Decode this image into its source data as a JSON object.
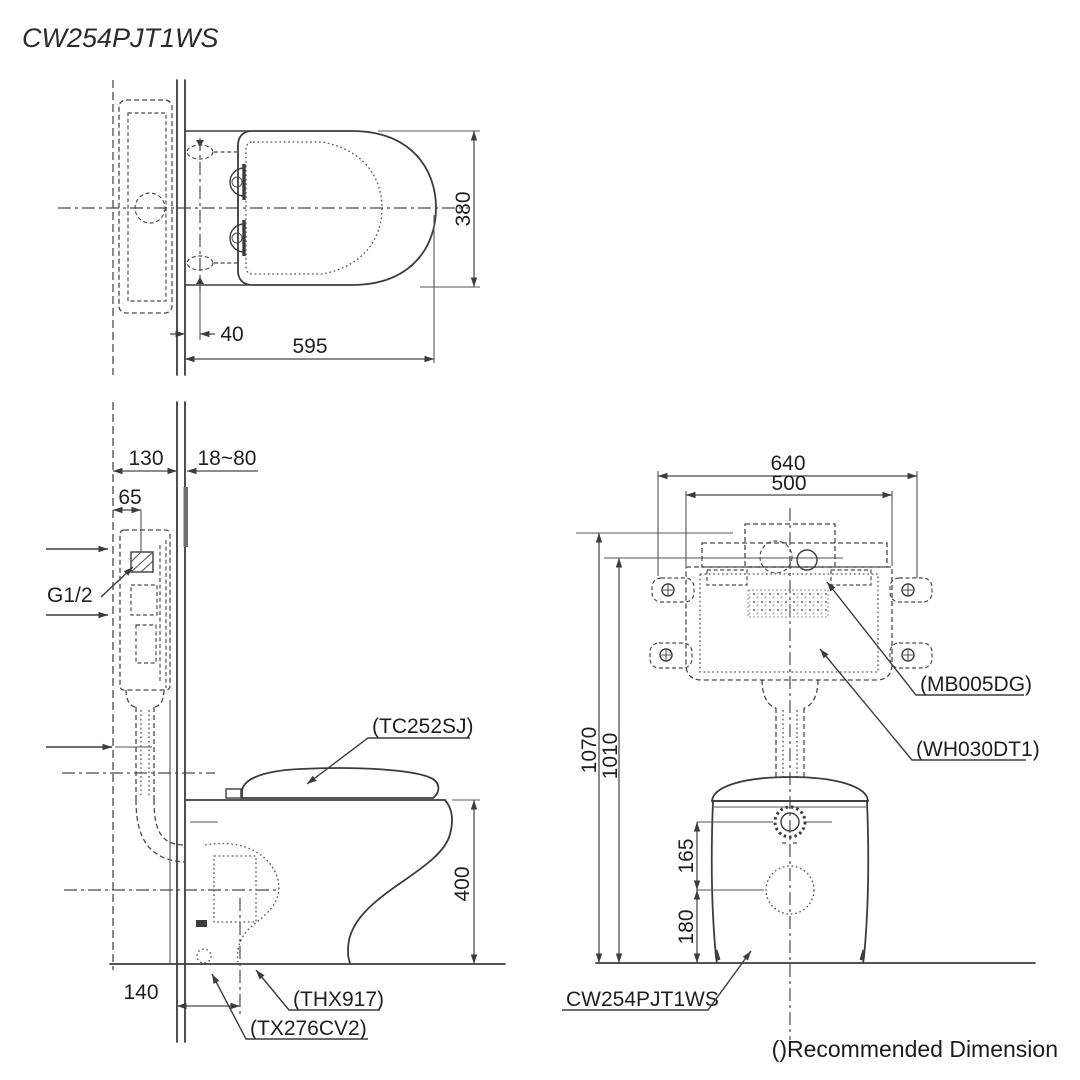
{
  "drawing": {
    "title": "CW254PJT1WS",
    "footnote": "()Recommended Dimension"
  },
  "top_view": {
    "dim_seat_width": "380",
    "dim_hinge_setback": "40",
    "dim_seat_length": "595"
  },
  "side_view": {
    "dim_frame_depth": "130",
    "dim_wall_thickness_range": "18~80",
    "dim_supply_offset": "65",
    "label_supply_connection": "G1/2",
    "label_seat_model": "(TC252SJ)",
    "dim_bowl_height": "400",
    "dim_outlet_setback": "140",
    "label_flush_accessory": "(THX917)",
    "label_stop_valve": "(TX276CV2)"
  },
  "front_view": {
    "dim_frame_width": "640",
    "dim_tank_width": "500",
    "dim_frame_height": "1070",
    "dim_actuator_height": "1010",
    "dim_inlet_spacing": "165",
    "dim_outlet_height": "180",
    "label_tank_model": "(MB005DG)",
    "label_frame_model": "(WH030DT1)",
    "label_bowl_model": "CW254PJT1WS"
  }
}
